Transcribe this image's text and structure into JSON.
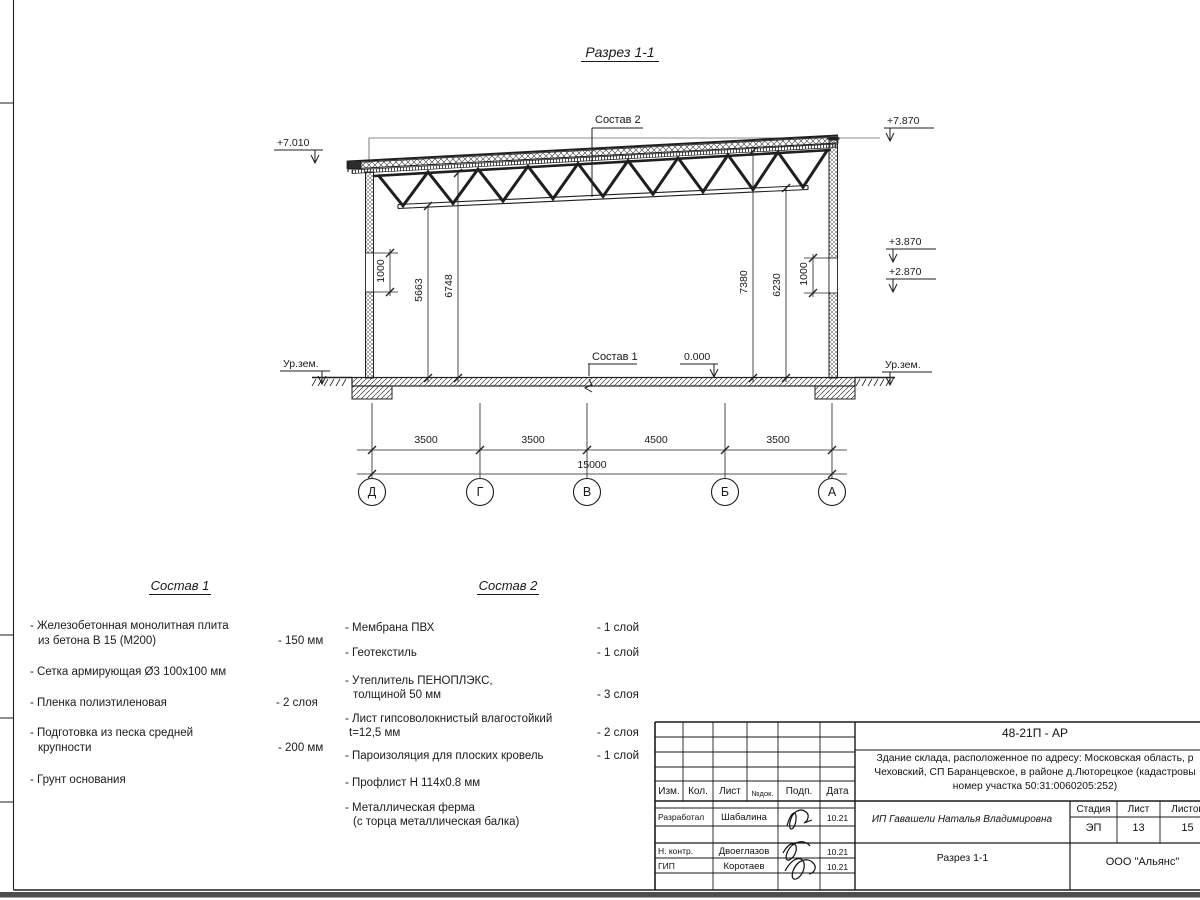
{
  "title": "Разрез 1-1",
  "drawing": {
    "section_ref2": "Состав 2",
    "section_ref1": "Состав 1",
    "zero": "0.000",
    "elev_left_top": "+7.010",
    "elev_right_top": "+7.870",
    "elev_right_1": "+3.870",
    "elev_right_2": "+2.870",
    "ground_left": "Ур.зем.",
    "ground_right": "Ур.зем.",
    "dim_1000_left": "1000",
    "dim_5663": "5663",
    "dim_6748": "6748",
    "dim_7380": "7380",
    "dim_6230": "6230",
    "dim_1000_right": "1000",
    "span_dims": [
      "3500",
      "3500",
      "4500",
      "3500"
    ],
    "total": "15000",
    "axes": [
      "Д",
      "Г",
      "В",
      "Б",
      "А"
    ]
  },
  "sostav1": {
    "title": "Состав 1",
    "items": [
      {
        "l1": "- Железобетонная  монолитная плита",
        "l2": "из бетона В 15 (М200)",
        "val": "- 150 мм"
      },
      {
        "l1": "- Сетка армирующая Ø3 100х100 мм"
      },
      {
        "l1": "- Пленка полиэтиленовая",
        "val": "-  2 слоя"
      },
      {
        "l1": "- Подготовка из песка средней",
        "l2": "крупности",
        "val": "- 200 мм"
      },
      {
        "l1": "- Грунт основания"
      }
    ]
  },
  "sostav2": {
    "title": "Состав 2",
    "items": [
      {
        "l1": "- Мембрана ПВХ",
        "val": "- 1 слой"
      },
      {
        "l1": "- Геотекстиль",
        "val": "- 1 слой"
      },
      {
        "l1": "- Утеплитель ПЕНОПЛЭКС,",
        "l2": "толщиной 50 мм",
        "val": "- 3 слоя"
      },
      {
        "l1": "- Лист гипсоволокнистый влагостойкий",
        "l2": "t=12,5 мм",
        "val": "- 2 слоя"
      },
      {
        "l1": "- Пароизоляция для плоских кровель",
        "val": "- 1 слой"
      },
      {
        "l1": "- Профлист Н 114х0.8 мм"
      },
      {
        "l1": "- Металлическая ферма",
        "l2": "(с торца металлическая балка)"
      }
    ]
  },
  "titleblock": {
    "code": "48-21П - АР",
    "address_line1": "Здание склада, расположенное по адресу: Московская область, р",
    "address_line2": "Чеховский, СП Баранцевское, в районе д.Люторецкое  (кадастровы",
    "address_line3": "номер участка 50:31:0060205:252)",
    "col_izm": "Изм.",
    "col_kol": "Кол.",
    "col_list": "Лист",
    "col_ndok": "№док.",
    "col_podp": "Подп.",
    "col_data": "Дата",
    "rows": [
      {
        "role": "Разработал",
        "name": "Шабалина",
        "date": "10.21"
      },
      {
        "role": "Н. контр.",
        "name": "Двоеглазов",
        "date": "10.21"
      },
      {
        "role": "ГИП",
        "name": "Коротаев",
        "date": "10.21"
      }
    ],
    "client": "ИП Гавашели Наталья Владимировна",
    "stage_label": "Стадия",
    "sheet_label": "Лист",
    "sheets_label": "Листов",
    "stage": "ЭП",
    "sheet": "13",
    "sheets": "15",
    "section_name": "Разрез 1-1",
    "company": "ООО \"Альянс\""
  }
}
